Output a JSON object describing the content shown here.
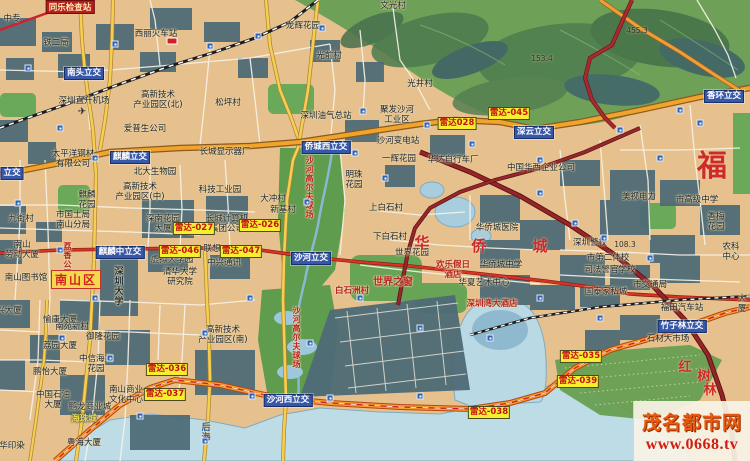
{
  "map": {
    "watermark": {
      "site_name": "茂名都市网",
      "site_url": "www.0668.tv"
    },
    "checkpoints": [
      {
        "t": "同乐检查站",
        "x": 70,
        "y": 0
      }
    ],
    "district_boxes": [
      {
        "t": "南山区",
        "x": 76,
        "y": 270
      }
    ],
    "radar_markers": [
      {
        "t": "雷达028",
        "x": 457,
        "y": 117
      },
      {
        "t": "雷达-045",
        "x": 509,
        "y": 107
      },
      {
        "t": "雷达-027",
        "x": 194,
        "y": 222
      },
      {
        "t": "雷达-026",
        "x": 260,
        "y": 219
      },
      {
        "t": "雷达-046",
        "x": 180,
        "y": 245
      },
      {
        "t": "雷达-047",
        "x": 241,
        "y": 245
      },
      {
        "t": "雷达-036",
        "x": 167,
        "y": 363
      },
      {
        "t": "雷达-037",
        "x": 165,
        "y": 388
      },
      {
        "t": "雷达-035",
        "x": 581,
        "y": 350
      },
      {
        "t": "雷达-039",
        "x": 578,
        "y": 375
      },
      {
        "t": "雷达-038",
        "x": 489,
        "y": 406
      }
    ],
    "interchanges": [
      {
        "t": "南头立交",
        "x": 84,
        "y": 67
      },
      {
        "t": "麒麟立交",
        "x": 130,
        "y": 151
      },
      {
        "t": "立交",
        "x": 12,
        "y": 167
      },
      {
        "t": "侨城西立交",
        "x": 326,
        "y": 141
      },
      {
        "t": "深云立交",
        "x": 534,
        "y": 126
      },
      {
        "t": "香环立交",
        "x": 724,
        "y": 90
      },
      {
        "t": "麒麟中立交",
        "x": 120,
        "y": 246
      },
      {
        "t": "沙河立交",
        "x": 311,
        "y": 252
      },
      {
        "t": "沙河西立交",
        "x": 288,
        "y": 394
      },
      {
        "t": "竹子林立交",
        "x": 682,
        "y": 320
      }
    ],
    "places": [
      {
        "t": "中专",
        "x": 12,
        "y": 15
      },
      {
        "t": "西丽火车站",
        "x": 156,
        "y": 30
      },
      {
        "t": "铁二局",
        "x": 56,
        "y": 39
      },
      {
        "t": "文光村",
        "x": 393,
        "y": 2
      },
      {
        "t": "龙辉花园",
        "x": 303,
        "y": 22
      },
      {
        "t": "光前村",
        "x": 329,
        "y": 52
      },
      {
        "t": "光井村",
        "x": 420,
        "y": 80
      },
      {
        "t": "松坪村",
        "x": 228,
        "y": 99
      },
      {
        "t": "深圳直升机场",
        "x": 84,
        "y": 97
      },
      {
        "t": "高新技术\n产业园区(北)",
        "x": 158,
        "y": 91
      },
      {
        "t": "爱普生公司",
        "x": 145,
        "y": 125
      },
      {
        "t": "深圳油气总站",
        "x": 326,
        "y": 112
      },
      {
        "t": "聚发沙河\n工业区",
        "x": 397,
        "y": 106
      },
      {
        "t": "沙河变电站",
        "x": 398,
        "y": 137
      },
      {
        "t": "一辉花园",
        "x": 399,
        "y": 155
      },
      {
        "t": "华达自行车厂",
        "x": 453,
        "y": 156
      },
      {
        "t": "中国华西企业公司",
        "x": 541,
        "y": 164
      },
      {
        "t": "美视电力",
        "x": 639,
        "y": 193
      },
      {
        "t": "市高级中学",
        "x": 697,
        "y": 196
      },
      {
        "t": "香梅\n花园",
        "x": 716,
        "y": 213
      },
      {
        "t": "农科中心",
        "x": 731,
        "y": 243
      },
      {
        "t": "太平洋钢材\n有限公司",
        "x": 73,
        "y": 150
      },
      {
        "t": "长城显示器厂",
        "x": 225,
        "y": 148
      },
      {
        "t": "北大生物园",
        "x": 155,
        "y": 168
      },
      {
        "t": "高新技术\n产业园区(中)",
        "x": 140,
        "y": 183
      },
      {
        "t": "科技工业园",
        "x": 220,
        "y": 186
      },
      {
        "t": "麒麟\n花园",
        "x": 87,
        "y": 191
      },
      {
        "t": "市国土局\n南山分局",
        "x": 73,
        "y": 211
      },
      {
        "t": "九街村",
        "x": 21,
        "y": 215
      },
      {
        "t": "深南花园\n大厦",
        "x": 163,
        "y": 215
      },
      {
        "t": "长城计算机\n集团公司",
        "x": 227,
        "y": 215
      },
      {
        "t": "联想",
        "x": 212,
        "y": 245
      },
      {
        "t": "大冲村",
        "x": 273,
        "y": 195
      },
      {
        "t": "新基村",
        "x": 283,
        "y": 206
      },
      {
        "t": "明珠\n花园",
        "x": 354,
        "y": 171
      },
      {
        "t": "上白石村",
        "x": 386,
        "y": 204
      },
      {
        "t": "下白石村",
        "x": 390,
        "y": 233
      },
      {
        "t": "世界花园",
        "x": 412,
        "y": 249
      },
      {
        "t": "华侨城中学",
        "x": 501,
        "y": 261
      },
      {
        "t": "华夏艺术中心",
        "x": 484,
        "y": 279
      },
      {
        "t": "华侨城医院",
        "x": 497,
        "y": 224
      },
      {
        "t": "深圳警校",
        "x": 590,
        "y": 239
      },
      {
        "t": "市第二体校",
        "x": 608,
        "y": 254
      },
      {
        "t": "司法警官学校",
        "x": 610,
        "y": 266
      },
      {
        "t": "国泰家私城",
        "x": 606,
        "y": 288
      },
      {
        "t": "市交通局",
        "x": 650,
        "y": 281
      },
      {
        "t": "福田汽车站",
        "x": 682,
        "y": 304
      },
      {
        "t": "石材大市场",
        "x": 668,
        "y": 335
      },
      {
        "t": "大厦",
        "x": 742,
        "y": 295
      },
      {
        "t": "南山\n劳动大厦",
        "x": 22,
        "y": 241
      },
      {
        "t": "南山图书馆",
        "x": 26,
        "y": 274
      },
      {
        "t": "虚拟大学园",
        "x": 172,
        "y": 256
      },
      {
        "t": "清华大学\n研究院",
        "x": 180,
        "y": 268
      },
      {
        "t": "中兴通讯",
        "x": 224,
        "y": 259
      },
      {
        "t": "南苑新村",
        "x": 72,
        "y": 323
      },
      {
        "t": "兴大厦",
        "x": 9,
        "y": 307
      },
      {
        "t": "愉康大厦",
        "x": 60,
        "y": 316
      },
      {
        "t": "荔园大厦",
        "x": 60,
        "y": 342
      },
      {
        "t": "鹏怡大厦",
        "x": 50,
        "y": 368
      },
      {
        "t": "御隆花园",
        "x": 103,
        "y": 333
      },
      {
        "t": "中信海文\n花园",
        "x": 96,
        "y": 355
      },
      {
        "t": "南山商业\n文化中心",
        "x": 126,
        "y": 386
      },
      {
        "t": "中国石油\n大厦",
        "x": 53,
        "y": 391
      },
      {
        "t": "鹏龙商业城",
        "x": 90,
        "y": 403
      },
      {
        "t": "粤海大厦",
        "x": 84,
        "y": 439
      },
      {
        "t": "华印染",
        "x": 12,
        "y": 442
      },
      {
        "t": "高新技术\n产业园区(南)",
        "x": 223,
        "y": 326
      }
    ],
    "red_places": [
      {
        "t": "世界之窗",
        "x": 393,
        "y": 277,
        "s": 10
      },
      {
        "t": "欢乐假日\n酒店",
        "x": 453,
        "y": 261
      },
      {
        "t": "深圳湾大酒店",
        "x": 492,
        "y": 300
      },
      {
        "t": "白石洲村",
        "x": 352,
        "y": 287
      }
    ],
    "yellow_places": [
      {
        "t": "海珠城",
        "x": 84,
        "y": 415
      }
    ],
    "big_red_chars": [
      {
        "t": "福",
        "x": 712,
        "y": 150,
        "s": 30
      },
      {
        "t": "华",
        "x": 422,
        "y": 235,
        "s": 15
      },
      {
        "t": "侨",
        "x": 479,
        "y": 238,
        "s": 15
      },
      {
        "t": "城",
        "x": 540,
        "y": 238,
        "s": 15
      },
      {
        "t": "红",
        "x": 685,
        "y": 361,
        "s": 13
      },
      {
        "t": "树",
        "x": 704,
        "y": 370,
        "s": 13
      },
      {
        "t": "林",
        "x": 710,
        "y": 384,
        "s": 13
      }
    ],
    "vertical_red": [
      {
        "t": "沙河高尔夫球场",
        "x": 309,
        "y": 156,
        "s": 8
      },
      {
        "t": "沙河高尔夫球场",
        "x": 296,
        "y": 306,
        "s": 8
      },
      {
        "t": "荔香公园",
        "x": 67,
        "y": 242,
        "s": 8
      }
    ],
    "vertical_dark": [
      {
        "t": "深圳大学",
        "x": 117,
        "y": 266,
        "s": 9
      }
    ],
    "vertical_blue": [
      {
        "t": "后海",
        "x": 204,
        "y": 422,
        "s": 9
      }
    ],
    "elevations": [
      {
        "t": "153.4",
        "x": 542,
        "y": 54
      },
      {
        "t": "455.3",
        "x": 637,
        "y": 26
      },
      {
        "t": "108.3",
        "x": 625,
        "y": 240
      }
    ],
    "icons": [
      {
        "name": "airport-icon",
        "glyph": "✈",
        "x": 82,
        "y": 112
      },
      {
        "name": "railway-station-icon",
        "glyph": "",
        "x": 172,
        "y": 41
      }
    ],
    "transit_stop_icons": [
      [
        28,
        68
      ],
      [
        115,
        44
      ],
      [
        210,
        46
      ],
      [
        258,
        36
      ],
      [
        322,
        28
      ],
      [
        363,
        111
      ],
      [
        427,
        125
      ],
      [
        472,
        144
      ],
      [
        540,
        193
      ],
      [
        575,
        223
      ],
      [
        604,
        238
      ],
      [
        660,
        158
      ],
      [
        700,
        123
      ],
      [
        95,
        158
      ],
      [
        60,
        128
      ],
      [
        18,
        203
      ],
      [
        60,
        250
      ],
      [
        95,
        298
      ],
      [
        62,
        338
      ],
      [
        110,
        358
      ],
      [
        205,
        333
      ],
      [
        250,
        298
      ],
      [
        310,
        343
      ],
      [
        360,
        298
      ],
      [
        420,
        328
      ],
      [
        490,
        338
      ],
      [
        540,
        298
      ],
      [
        600,
        318
      ],
      [
        650,
        258
      ],
      [
        330,
        398
      ],
      [
        420,
        396
      ],
      [
        252,
        396
      ],
      [
        140,
        416
      ],
      [
        205,
        441
      ],
      [
        307,
        202
      ],
      [
        355,
        153
      ],
      [
        385,
        178
      ],
      [
        540,
        160
      ],
      [
        620,
        130
      ],
      [
        680,
        110
      ]
    ]
  }
}
